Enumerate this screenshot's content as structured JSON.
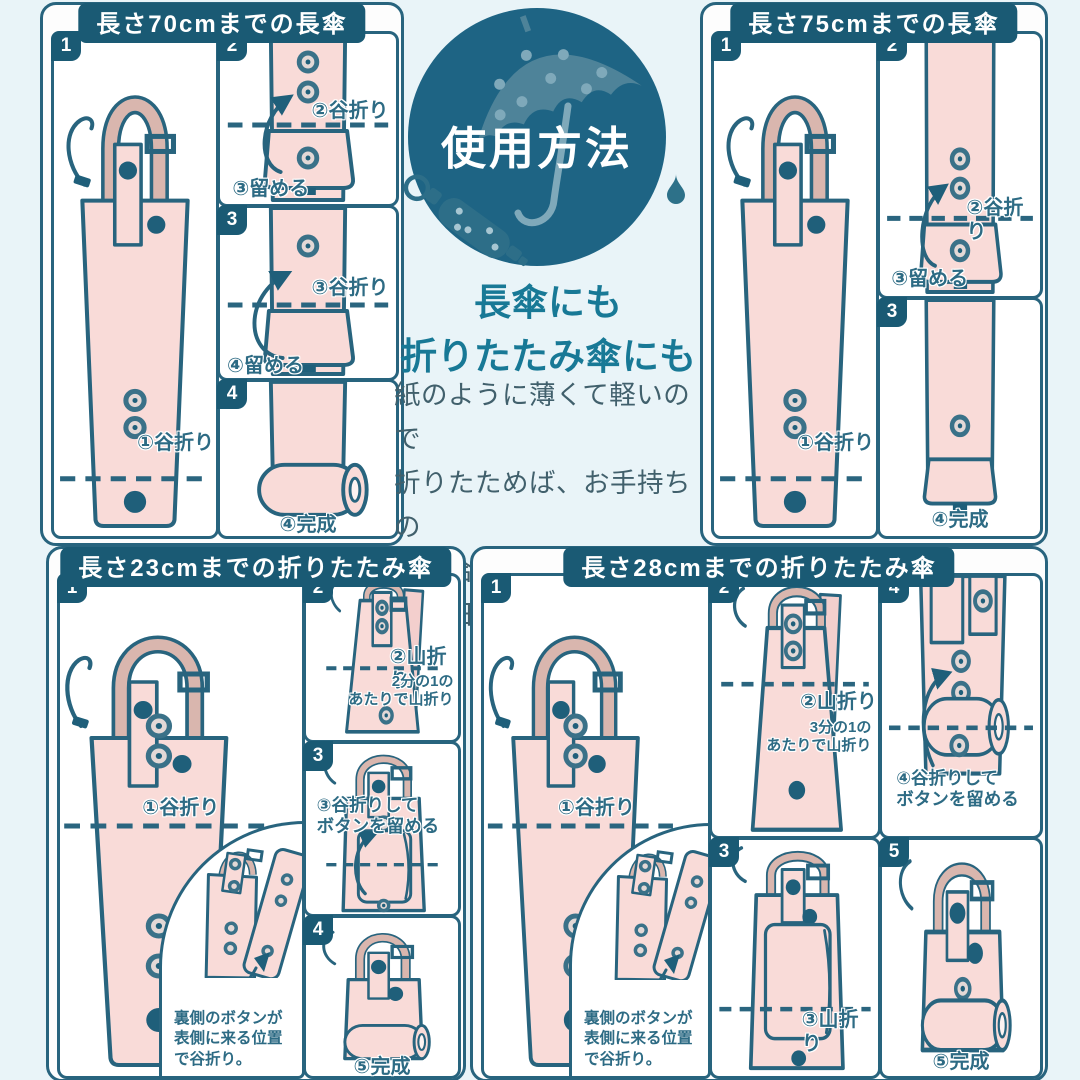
{
  "colors": {
    "accent": "#28647e",
    "header_bg": "#1a5a74",
    "pouch_pink": "#f9dbd8",
    "handle_pink": "#d9b6ae",
    "background": "#e9f4f8",
    "badge_circle": "#1e6484",
    "headline_teal": "#187996",
    "body_text": "#41606c"
  },
  "center": {
    "badge": "使用方法",
    "headline1": "長傘にも",
    "headline2": "折りたたみ傘にも",
    "body": "紙のように薄くて軽いので\n折りたためば、お手持ちの\n傘に合わせられます。\n雨の日の必須アイテムに！"
  },
  "panels": {
    "p70": {
      "title": "長さ70cmまでの長傘",
      "s1_num": "1",
      "s1_label": "①谷折り",
      "s2_num": "2",
      "s2_fold": "②谷折り",
      "s2_fasten": "③留める",
      "s3_num": "3",
      "s3_fold": "③谷折り",
      "s3_fasten": "④留める",
      "s4_num": "4",
      "s4_done": "④完成"
    },
    "p75": {
      "title": "長さ75cmまでの長傘",
      "s1_num": "1",
      "s1_label": "①谷折り",
      "s2_num": "2",
      "s2_fold": "②谷折り",
      "s2_fasten": "③留める",
      "s3_num": "3",
      "s3_done": "④完成"
    },
    "p23": {
      "title": "長さ23cmまでの折りたたみ傘",
      "s1_num": "1",
      "s1_label": "①谷折り",
      "s1_inset_note": "裏側のボタンが\n表側に来る位置\nで谷折り。",
      "s2_num": "2",
      "s2_label": "②山折り",
      "s2_note": "2分の1の\nあたりで山折り",
      "s3_num": "3",
      "s3_label": "③谷折りして\nボタンを留める",
      "s4_num": "4",
      "s4_done": "⑤完成"
    },
    "p28": {
      "title": "長さ28cmまでの折りたたみ傘",
      "s1_num": "1",
      "s1_label": "①谷折り",
      "s1_inset_note": "裏側のボタンが\n表側に来る位置\nで谷折り。",
      "s2_num": "2",
      "s2_label": "②山折り",
      "s2_note": "3分の1の\nあたりで山折り",
      "s3_num": "3",
      "s3_label": "③山折り",
      "s4_num": "4",
      "s4_label": "④谷折りして\nボタンを留める",
      "s5_num": "5",
      "s5_done": "⑤完成"
    }
  }
}
